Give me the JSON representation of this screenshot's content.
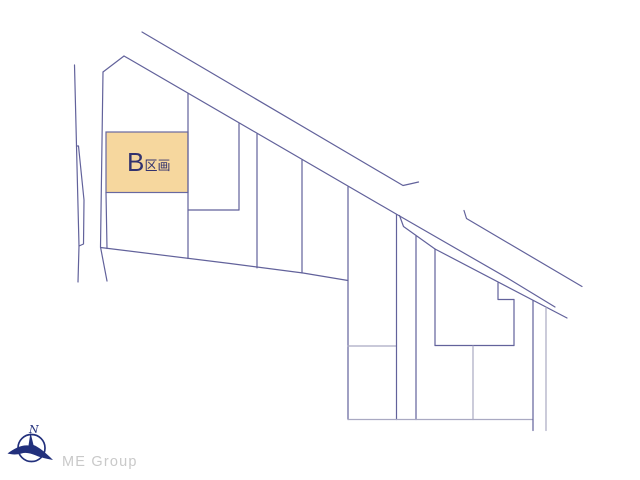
{
  "canvas": {
    "width": 640,
    "height": 480
  },
  "colors": {
    "background": "#ffffff",
    "line_medium": "#62629b",
    "line_light": "#a9a9c2",
    "parcel_b_fill": "#f6d79e",
    "parcel_b_stroke": "#6868a0",
    "label_text": "#32326e",
    "compass_navy": "#22307c",
    "brand_gray": "#c9c9c9"
  },
  "diagram": {
    "parcel_b": {
      "label_main": "B",
      "label_suffix": "区画",
      "rect": {
        "x": 106,
        "y": 132,
        "w": 82,
        "h": 60.5
      }
    },
    "lines": [
      {
        "name": "road-upper-edge",
        "w": "m",
        "pts": [
          [
            142,
            32
          ],
          [
            403,
            185.5
          ],
          [
            412,
            183.5
          ],
          [
            418.5,
            182
          ]
        ]
      },
      {
        "name": "road-lower-edge",
        "w": "m",
        "pts": [
          [
            124,
            56
          ],
          [
            397,
            214.5
          ],
          [
            509,
            279
          ],
          [
            555,
            307
          ]
        ]
      },
      {
        "name": "road-branch-right",
        "w": "m",
        "pts": [
          [
            464,
            210.5
          ],
          [
            466.5,
            218.5
          ],
          [
            582,
            286.5
          ]
        ]
      },
      {
        "name": "flag-strip-edge",
        "w": "m",
        "pts": [
          [
            399.5,
            215.5
          ],
          [
            403.5,
            226.5
          ],
          [
            435,
            249
          ],
          [
            567,
            318
          ]
        ]
      },
      {
        "name": "west-boundary-outer",
        "w": "m",
        "pts": [
          [
            74.5,
            65
          ],
          [
            76.5,
            146
          ],
          [
            79,
            246
          ],
          [
            78,
            282
          ]
        ]
      },
      {
        "name": "west-boundary-inner",
        "w": "m",
        "pts": [
          [
            76.5,
            146
          ],
          [
            78.5,
            146
          ],
          [
            84,
            200
          ],
          [
            83.5,
            244
          ],
          [
            79,
            246
          ]
        ]
      },
      {
        "name": "west-boundary-third",
        "w": "m",
        "pts": [
          [
            103,
            72
          ],
          [
            100.5,
            247
          ],
          [
            107,
            281
          ]
        ]
      },
      {
        "name": "apex-left-edge",
        "w": "m",
        "pts": [
          [
            103,
            72
          ],
          [
            124,
            56
          ]
        ]
      },
      {
        "name": "south-boundary-diagonal",
        "w": "m",
        "pts": [
          [
            100.5,
            247.5
          ],
          [
            230,
            263.5
          ],
          [
            303,
            273
          ],
          [
            348,
            280.5
          ]
        ]
      },
      {
        "name": "parcel-b-left-extension",
        "w": "m",
        "pts": [
          [
            106,
            192.5
          ],
          [
            107,
            248.5
          ]
        ]
      },
      {
        "name": "boundary-x188",
        "w": "m",
        "pts": [
          [
            188,
            93.5
          ],
          [
            188,
            258.5
          ]
        ]
      },
      {
        "name": "boundary-y210",
        "w": "m",
        "pts": [
          [
            188,
            210
          ],
          [
            239,
            210
          ]
        ]
      },
      {
        "name": "boundary-x239",
        "w": "m",
        "pts": [
          [
            239,
            123.5
          ],
          [
            239,
            210
          ]
        ]
      },
      {
        "name": "boundary-x257",
        "w": "m",
        "pts": [
          [
            257,
            134
          ],
          [
            257,
            267.9
          ]
        ]
      },
      {
        "name": "boundary-x302",
        "w": "m",
        "pts": [
          [
            302,
            160
          ],
          [
            302,
            273
          ]
        ]
      },
      {
        "name": "boundary-x348",
        "w": "m",
        "pts": [
          [
            348,
            187
          ],
          [
            348,
            419.5
          ]
        ]
      },
      {
        "name": "stub-y346",
        "w": "l",
        "pts": [
          [
            348,
            346
          ],
          [
            396.5,
            346
          ]
        ]
      },
      {
        "name": "boundary-x396",
        "w": "m",
        "pts": [
          [
            396.5,
            214.5
          ],
          [
            396.5,
            419.5
          ]
        ]
      },
      {
        "name": "boundary-x416",
        "w": "m",
        "pts": [
          [
            416,
            235.5
          ],
          [
            416,
            419.5
          ]
        ]
      },
      {
        "name": "pentagon-left",
        "w": "m",
        "pts": [
          [
            435,
            249
          ],
          [
            435,
            345.5
          ]
        ]
      },
      {
        "name": "pentagon-bottom",
        "w": "m",
        "pts": [
          [
            435,
            345.5
          ],
          [
            514,
            345.5
          ]
        ]
      },
      {
        "name": "pentagon-right",
        "w": "m",
        "pts": [
          [
            514,
            299.5
          ],
          [
            514,
            345.5
          ]
        ]
      },
      {
        "name": "pentagon-notch",
        "w": "m",
        "pts": [
          [
            498,
            283
          ],
          [
            498,
            299.5
          ],
          [
            514,
            299.5
          ]
        ]
      },
      {
        "name": "boundary-x473",
        "w": "l",
        "pts": [
          [
            473,
            346
          ],
          [
            473,
            419.5
          ]
        ]
      },
      {
        "name": "south-horizontal",
        "w": "l",
        "pts": [
          [
            348,
            419.5
          ],
          [
            533,
            419.5
          ]
        ]
      },
      {
        "name": "boundary-x533",
        "w": "m",
        "pts": [
          [
            533,
            300.5
          ],
          [
            533,
            430.5
          ]
        ]
      },
      {
        "name": "boundary-x546",
        "w": "l",
        "pts": [
          [
            546,
            307.5
          ],
          [
            546,
            430.5
          ]
        ]
      }
    ]
  },
  "compass": {
    "north_label": "N"
  },
  "branding": {
    "company": "ME Group"
  }
}
